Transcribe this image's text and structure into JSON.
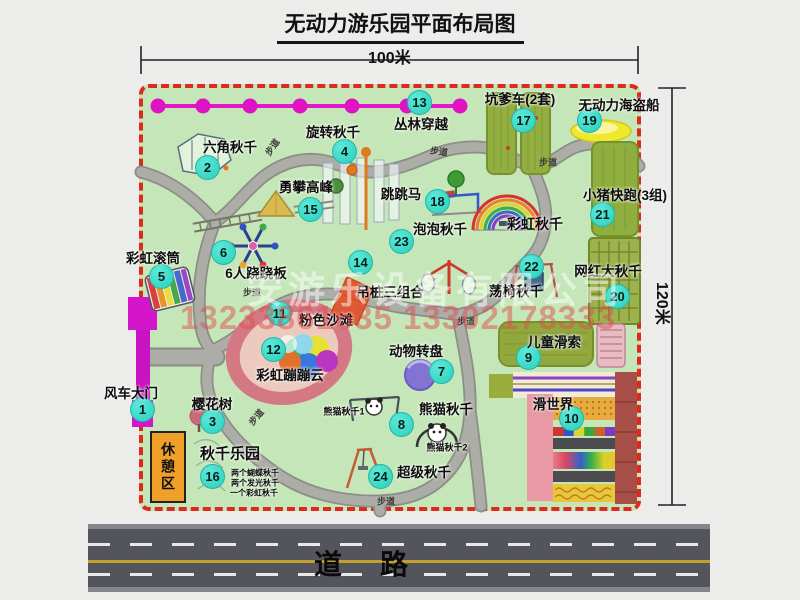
{
  "title": "无动力游乐园平面布局图",
  "dimensions": {
    "width_label": "100米",
    "height_label": "120米"
  },
  "road": {
    "label": "道路"
  },
  "rest_area_label": "休憩区",
  "watermark": {
    "company": "安游乐设备有限公司",
    "phone_numbers": "13233861635 13302178333"
  },
  "colors": {
    "map_green": "#c5e6b8",
    "border_red": "#de291d",
    "badge_cyan": "#3cdccb",
    "gate_magenta": "#d316cc",
    "zipline_magenta": "#e418c8",
    "road_gray": "#54545c",
    "equipment_olive": "#92ad40",
    "beach_pink": "#d47884",
    "rest_area_orange": "#f0a028"
  },
  "markers": [
    {
      "num": 1,
      "label": "风车大门",
      "bx": 142,
      "by": 409,
      "lx": 131,
      "ly": 392
    },
    {
      "num": 2,
      "label": "六角秋千",
      "bx": 207,
      "by": 167,
      "lx": 230,
      "ly": 146
    },
    {
      "num": 3,
      "label": "樱花树",
      "bx": 212,
      "by": 421,
      "lx": 212,
      "ly": 403
    },
    {
      "num": 4,
      "label": "旋转秋千",
      "bx": 344,
      "by": 151,
      "lx": 333,
      "ly": 131
    },
    {
      "num": 5,
      "label": "彩虹滚筒",
      "bx": 161,
      "by": 276,
      "lx": 153,
      "ly": 257
    },
    {
      "num": 6,
      "label": "6人跷跷板",
      "bx": 223,
      "by": 252,
      "lx": 256,
      "ly": 272
    },
    {
      "num": 7,
      "label": "动物转盘",
      "bx": 441,
      "by": 371,
      "lx": 416,
      "ly": 350
    },
    {
      "num": 8,
      "label": "熊猫秋千",
      "bx": 401,
      "by": 424,
      "lx": 446,
      "ly": 408
    },
    {
      "num": 9,
      "label": "儿童滑索",
      "bx": 528,
      "by": 357,
      "lx": 554,
      "ly": 341
    },
    {
      "num": 10,
      "label": "滑世界",
      "bx": 571,
      "by": 418,
      "lx": 553,
      "ly": 403
    },
    {
      "num": 11,
      "label": "粉色沙滩",
      "bx": 279,
      "by": 313,
      "lx": 326,
      "ly": 319
    },
    {
      "num": 12,
      "label": "彩虹蹦蹦云",
      "bx": 273,
      "by": 349,
      "lx": 290,
      "ly": 374
    },
    {
      "num": 13,
      "label": "丛林穿越",
      "bx": 419,
      "by": 102,
      "lx": 421,
      "ly": 123
    },
    {
      "num": 14,
      "label": "吊桩三组合",
      "bx": 360,
      "by": 262,
      "lx": 390,
      "ly": 291
    },
    {
      "num": 15,
      "label": "勇攀高峰",
      "bx": 310,
      "by": 209,
      "lx": 306,
      "ly": 186
    },
    {
      "num": 16,
      "label": "秋千乐园",
      "bx": 212,
      "by": 476,
      "lx": 230,
      "ly": 453,
      "size": 15
    },
    {
      "num": 17,
      "label": "坑爹车(2套)",
      "bx": 523,
      "by": 120,
      "lx": 520,
      "ly": 98
    },
    {
      "num": 18,
      "label": "跳跳马",
      "bx": 437,
      "by": 201,
      "lx": 401,
      "ly": 193
    },
    {
      "num": 19,
      "label": "无动力海盗船",
      "bx": 589,
      "by": 120,
      "lx": 619,
      "ly": 104
    },
    {
      "num": 20,
      "label": "网红大秋千",
      "bx": 617,
      "by": 296,
      "lx": 608,
      "ly": 270
    },
    {
      "num": 21,
      "label": "小猪快跑(3组)",
      "bx": 602,
      "by": 214,
      "lx": 625,
      "ly": 194
    },
    {
      "num": 22,
      "label": "荡椅秋千",
      "bx": 531,
      "by": 266,
      "lx": 516,
      "ly": 290
    },
    {
      "num": 23,
      "label": "泡泡秋千",
      "bx": 401,
      "by": 241,
      "lx": 440,
      "ly": 228
    },
    {
      "num": 24,
      "label": "超级秋千",
      "bx": 380,
      "by": 476,
      "lx": 424,
      "ly": 471
    }
  ],
  "extra_labels": [
    {
      "text": "彩虹秋千",
      "x": 535,
      "y": 224,
      "size": 14
    },
    {
      "text": "熊猫秋千1",
      "x": 344,
      "y": 411,
      "size": 9
    },
    {
      "text": "熊猫秋千2",
      "x": 447,
      "y": 447,
      "size": 9
    },
    {
      "text": "两个蝴蝶秋千",
      "x": 255,
      "y": 473,
      "size": 8
    },
    {
      "text": "两个发光秋千",
      "x": 255,
      "y": 483,
      "size": 8
    },
    {
      "text": "一个彩虹秋千",
      "x": 254,
      "y": 493,
      "size": 8
    }
  ],
  "path_labels": [
    {
      "text": "步道",
      "x": 272,
      "y": 147,
      "rot": -55
    },
    {
      "text": "步道",
      "x": 439,
      "y": 151,
      "rot": 8
    },
    {
      "text": "步道",
      "x": 548,
      "y": 162,
      "rot": 0
    },
    {
      "text": "步道",
      "x": 252,
      "y": 292,
      "rot": 0
    },
    {
      "text": "步道",
      "x": 466,
      "y": 321,
      "rot": 0
    },
    {
      "text": "步道",
      "x": 256,
      "y": 417,
      "rot": -50
    },
    {
      "text": "步道",
      "x": 386,
      "y": 501,
      "rot": 0
    }
  ]
}
